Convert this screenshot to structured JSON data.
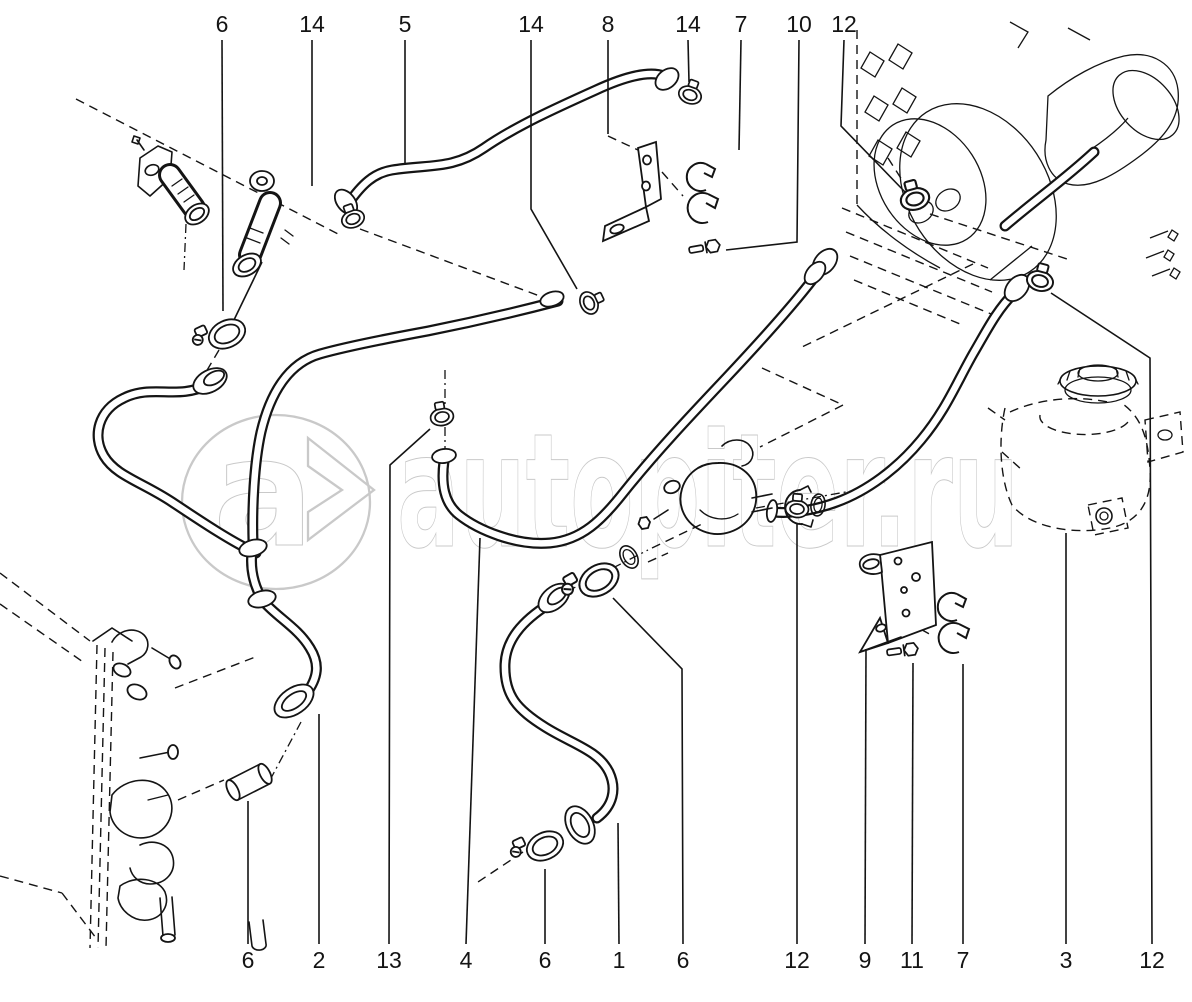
{
  "page": {
    "background": "#ffffff",
    "line_color": "#141414"
  },
  "watermark": {
    "logo_letter": "a",
    "logo_chevron": ">",
    "text": "autopiter.ru",
    "color": "#c9c9c9"
  },
  "callouts": {
    "top": [
      {
        "label": "6",
        "x": 222
      },
      {
        "label": "14",
        "x": 312
      },
      {
        "label": "5",
        "x": 405
      },
      {
        "label": "14",
        "x": 531
      },
      {
        "label": "8",
        "x": 608
      },
      {
        "label": "14",
        "x": 688
      },
      {
        "label": "7",
        "x": 741
      },
      {
        "label": "10",
        "x": 799
      },
      {
        "label": "12",
        "x": 844
      }
    ],
    "bottom": [
      {
        "label": "6",
        "x": 248
      },
      {
        "label": "2",
        "x": 319
      },
      {
        "label": "13",
        "x": 389
      },
      {
        "label": "4",
        "x": 466
      },
      {
        "label": "6",
        "x": 545
      },
      {
        "label": "1",
        "x": 619
      },
      {
        "label": "6",
        "x": 683
      },
      {
        "label": "12",
        "x": 797
      },
      {
        "label": "9",
        "x": 865
      },
      {
        "label": "11",
        "x": 912
      },
      {
        "label": "7",
        "x": 963
      },
      {
        "label": "3",
        "x": 1066
      },
      {
        "label": "12",
        "x": 1152
      }
    ]
  }
}
